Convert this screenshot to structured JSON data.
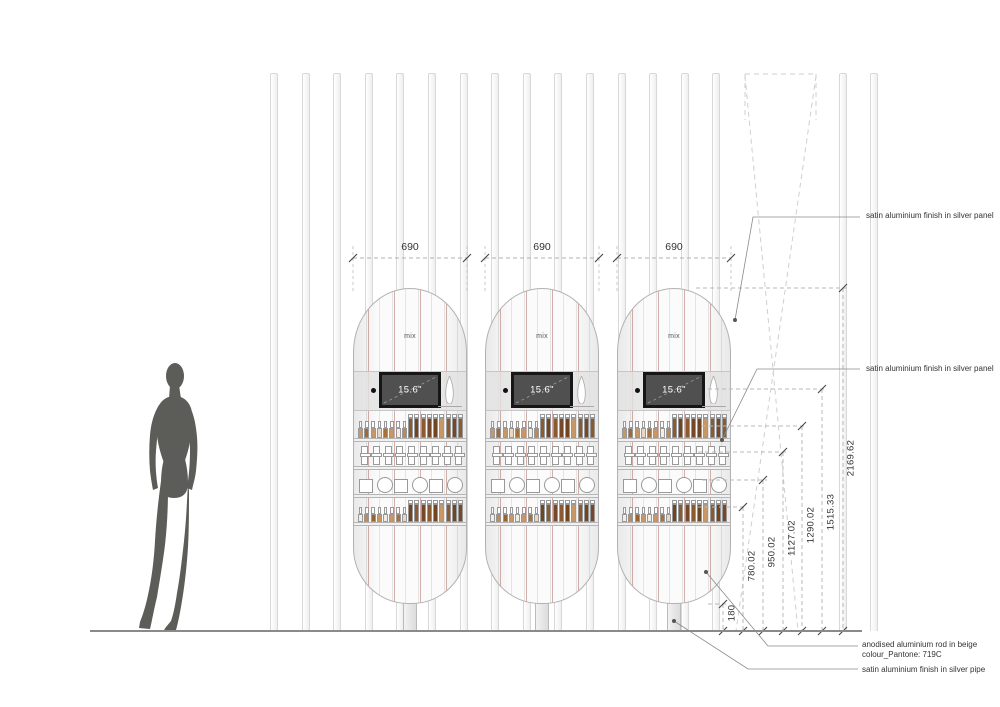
{
  "units": {
    "count": 3,
    "width_label": "690",
    "dome_label": "mix",
    "screen_label": "15.6\""
  },
  "width_dimensions": [
    "690",
    "690",
    "690"
  ],
  "height_dimensions": [
    "180",
    "780.02",
    "950.02",
    "1127.02",
    "1290.02",
    "1515.33",
    "2169.62"
  ],
  "annotations": {
    "panel_top": "satin aluminium finish in silver panel",
    "panel_mid": "satin aluminium finish in silver panel",
    "rod_line1": "anodised aluminium rod in beige",
    "rod_line2": "colour_Pantone: 719C",
    "pipe": "satin aluminium finish in silver pipe"
  },
  "colors": {
    "silver_panel": "#e2e2e2",
    "beige_rod_accent": "#aa645a",
    "screen_frame": "#161616",
    "screen_face": "#505050",
    "ground": "#8a8a8a",
    "figure": "#5c5c58",
    "dimension_text": "#333333",
    "product_outline": "#999999"
  },
  "shelves": {
    "row1_bottles": [
      "#c79766",
      "#a06a32",
      "#c79766",
      "#e9d9c4",
      "#a9713a",
      "#c79766",
      "#f3ede3",
      "#b98a55",
      "#8a5a30",
      "#6f4522",
      "#8a5a30",
      "#76482a",
      "#6f4522",
      "#c79766",
      "#8a5a30",
      "#76482a",
      "#8a5a30"
    ],
    "row2_jars_count": 9,
    "row3_compacts": [
      "square",
      "circle",
      "square",
      "circle",
      "square",
      "circle"
    ],
    "row4_bottles": [
      "#f3ede3",
      "#c08a52",
      "#9a622e",
      "#c79766",
      "#f3ede3",
      "#c79766",
      "#a9713a",
      "#e9d9c4",
      "#6f4522",
      "#8a5a30",
      "#76482a",
      "#8a5a30",
      "#6f4522",
      "#c79766",
      "#8a5a30",
      "#6f4522",
      "#76482a"
    ]
  }
}
